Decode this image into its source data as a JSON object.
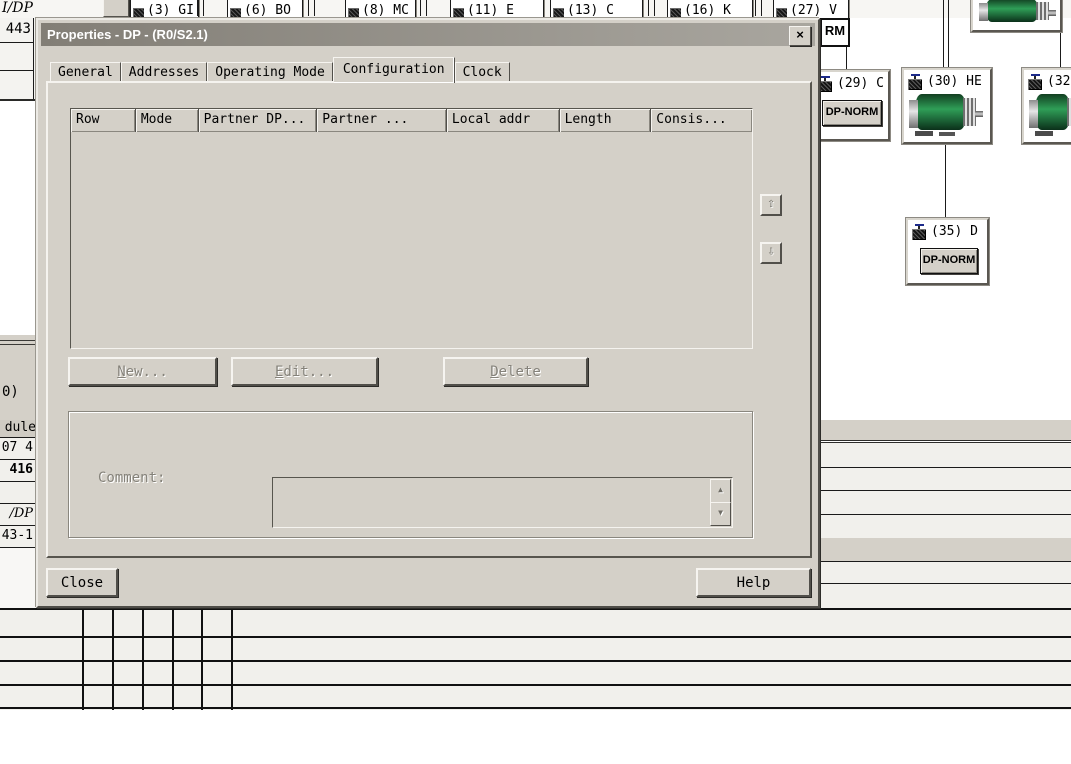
{
  "window": {
    "title": "Properties - DP - (R0/S2.1)",
    "close_glyph": "×",
    "tabs": [
      "General",
      "Addresses",
      "Operating Mode",
      "Configuration",
      "Clock"
    ],
    "active_tab": "Configuration",
    "table": {
      "columns": [
        "Row",
        "Mode",
        "Partner DP...",
        "Partner ...",
        "Local addr",
        "Length",
        "Consis..."
      ],
      "rows": []
    },
    "move_up_glyph": "⇧",
    "move_down_glyph": "⇩",
    "buttons": {
      "new": "New...",
      "edit": "Edit...",
      "delete": "Delete",
      "close": "Close",
      "help": "Help"
    },
    "comment_label": "Comment:",
    "scroll_up_glyph": "▲",
    "scroll_down_glyph": "▼"
  },
  "background": {
    "bus_label": "I/DP",
    "bus_devices": [
      "(3) GI",
      "(6) BO",
      "(8) MC",
      "(11) E",
      "(13) C",
      "(16) K",
      "(27) V"
    ],
    "rm_badge": "RM",
    "devices": [
      {
        "label": "(29) C",
        "badge": "DP-NORM"
      },
      {
        "label": "(30) HE"
      },
      {
        "label": "(32"
      },
      {
        "label": "(35) D",
        "badge": "DP-NORM"
      }
    ],
    "left_pane": {
      "cell_top": "443",
      "text_mid": "0)",
      "header": "dule",
      "rows": [
        "07 4",
        "416",
        "",
        "/DP",
        "43-1"
      ]
    }
  },
  "colors": {
    "dialog_face": "#d4d0c8",
    "title_gradient_from": "#827e76",
    "title_gradient_to": "#a9a69f",
    "motor_green": "#2f9e57",
    "row_bg": "#f1f0ec"
  }
}
